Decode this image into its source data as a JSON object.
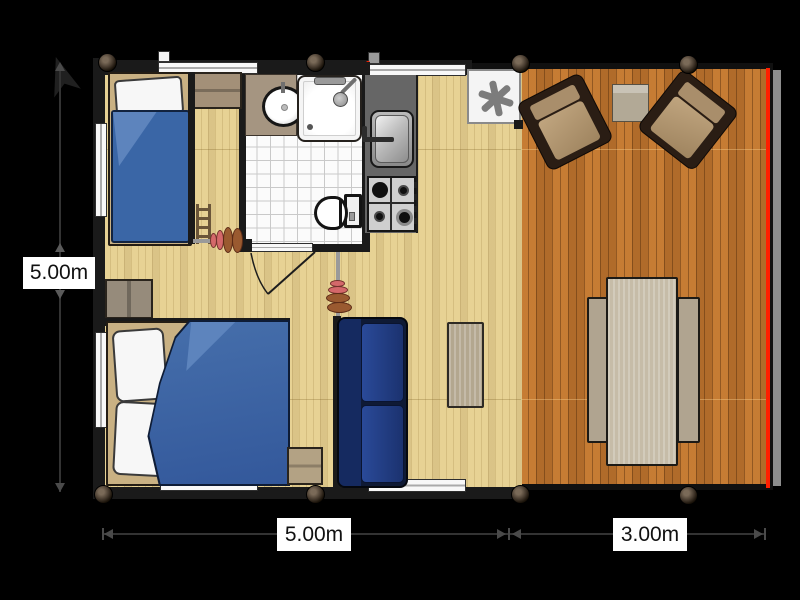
{
  "dimensions": {
    "left": "5.00m",
    "bottom_main": "5.00m",
    "bottom_deck": "3.00m"
  },
  "icons": {
    "boiler_symbol": "six-spoke-asterisk",
    "north_arrow": "north-arrow",
    "shower_head": "shower-head",
    "curtain": "rolled-curtain-coil"
  },
  "colors": {
    "background": "#000000",
    "interior_floor": "#e7d294",
    "deck_floor": "#c0762f",
    "wall": "#1a1a1a",
    "bed_blue": "#3a66a6",
    "sofa_navy": "#0f1a35",
    "accent_red": "#ff1e00",
    "curtain_pink": "#d4686a",
    "curtain_brown": "#9a5a30",
    "counter_gray": "#666666",
    "furniture_tan": "#b3a78f"
  }
}
